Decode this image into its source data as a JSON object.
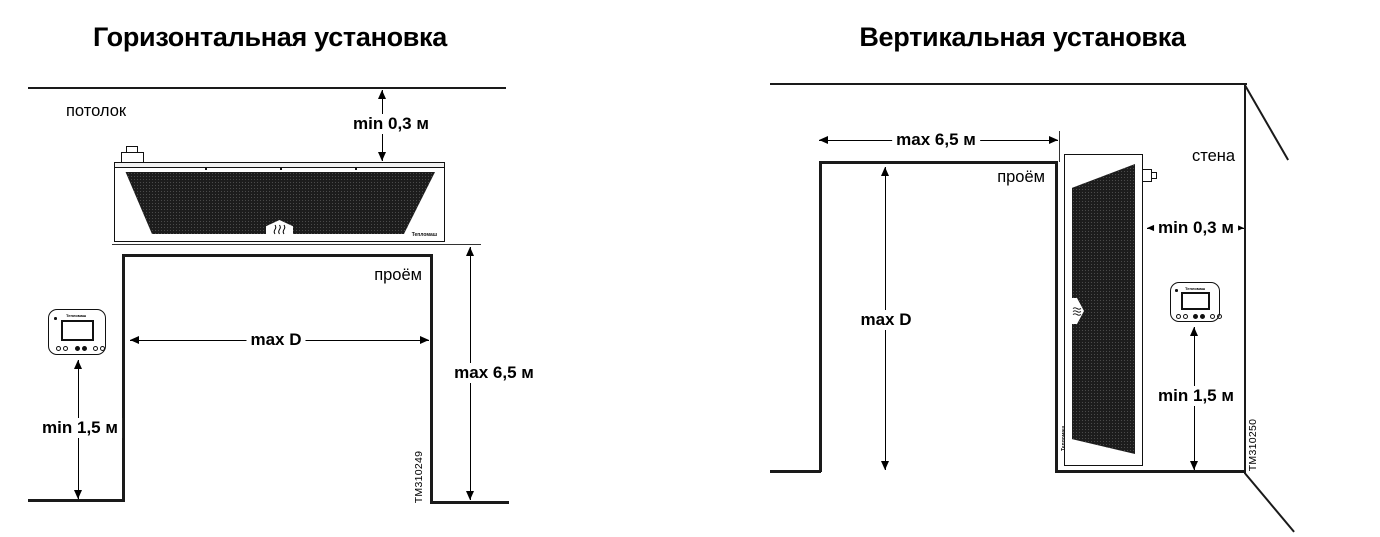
{
  "diagrams": {
    "horizontal": {
      "title": "Горизонтальная установка",
      "ceiling_label": "потолок",
      "opening_label": "проём",
      "dim_ceiling_gap": "min 0,3 м",
      "dim_opening_width": "max D",
      "dim_opening_height": "max 6,5 м",
      "dim_controller_height": "min 1,5 м",
      "figure_id": "TM310249",
      "brand": "Тепломаш"
    },
    "vertical": {
      "title": "Вертикальная установка",
      "wall_label": "стена",
      "opening_label": "проём",
      "dim_opening_width": "max 6,5 м",
      "dim_opening_height": "max D",
      "dim_wall_gap": "min 0,3 м",
      "dim_controller_height": "min 1,5 м",
      "figure_id": "TM310250",
      "brand": "Тепломаш"
    }
  },
  "colors": {
    "line": "#1a1a1a",
    "grille": "#1c1c1c",
    "background": "#ffffff",
    "text": "#000000"
  }
}
